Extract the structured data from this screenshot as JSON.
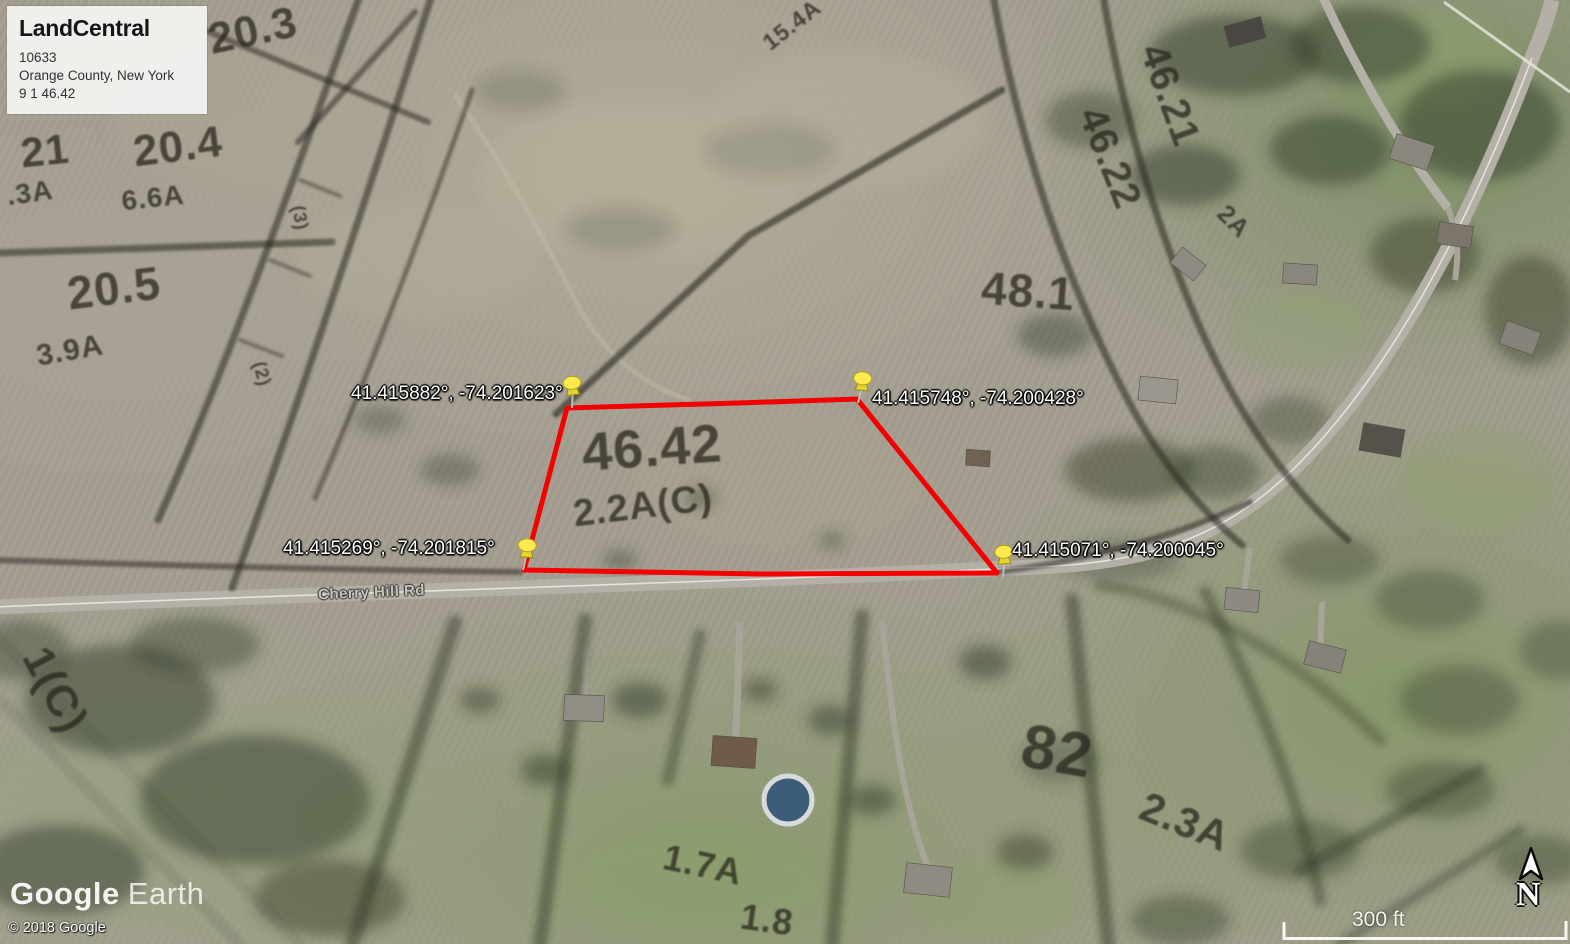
{
  "info_card": {
    "brand": "LandCentral",
    "listing_id": "10633",
    "location": "Orange County, New York",
    "parcel_ref": "9 1 46.42"
  },
  "pins": [
    {
      "label": "41.415882°, -74.201623°"
    },
    {
      "label": "41.415748°, -74.200428°"
    },
    {
      "label": "41.415269°, -74.201815°"
    },
    {
      "label": "41.415071°, -74.200045°"
    }
  ],
  "map": {
    "road_label": "Cherry Hill Rd",
    "parcel_labels": [
      {
        "text": "20.3"
      },
      {
        "text": "21"
      },
      {
        "text": ".3A"
      },
      {
        "text": "20.4"
      },
      {
        "text": "6.6A"
      },
      {
        "text": "20.5"
      },
      {
        "text": "3.9A"
      },
      {
        "text": "15.4A"
      },
      {
        "text": "46.21"
      },
      {
        "text": "46.22"
      },
      {
        "text": "2A"
      },
      {
        "text": "48.1"
      },
      {
        "text": "46.42"
      },
      {
        "text": "2.2A(C)"
      },
      {
        "text": "82"
      },
      {
        "text": "2.3A"
      },
      {
        "text": "1.7A"
      },
      {
        "text": "1.8"
      },
      {
        "text": "1(C)"
      },
      {
        "text": "(3)"
      },
      {
        "text": "(2)"
      }
    ]
  },
  "attribution": {
    "logo_primary": "Google",
    "logo_secondary": "Earth",
    "copyright": "© 2018 Google"
  },
  "scale_bar": {
    "label": "300 ft"
  },
  "compass": {
    "label": "N"
  },
  "colors": {
    "parcel_outline": "#f40000",
    "pin_head": "#ffe94f",
    "info_card_bg": "#f3f2f0",
    "road": "#b4b0a7"
  }
}
